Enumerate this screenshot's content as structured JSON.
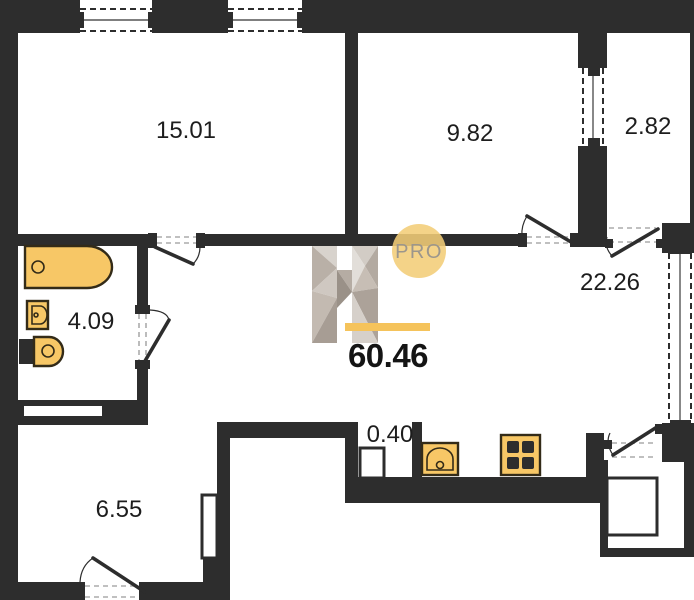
{
  "plan": {
    "title": "apartment-floor-plan",
    "total_area": "60.46",
    "brand": {
      "logo_letter": "H",
      "badge": "PRO"
    },
    "areas": {
      "room_15": "15.01",
      "room_9": "9.82",
      "balcony": "2.82",
      "living": "22.26",
      "bathroom": "4.09",
      "duct": "0.40",
      "hall": "6.55"
    },
    "fixtures": [
      "bathtub",
      "washbasin",
      "toilet",
      "kitchen-sink",
      "stove"
    ],
    "colors": {
      "wall": "#2d2d2d",
      "fixture_fill": "#f7c766",
      "fixture_stroke": "#332b18",
      "accent": "#f5c35b",
      "badge_fill": "#f2cd78",
      "badge_text": "#9c968c",
      "label_text": "#1d1d1d",
      "background": "#ffffff"
    }
  }
}
